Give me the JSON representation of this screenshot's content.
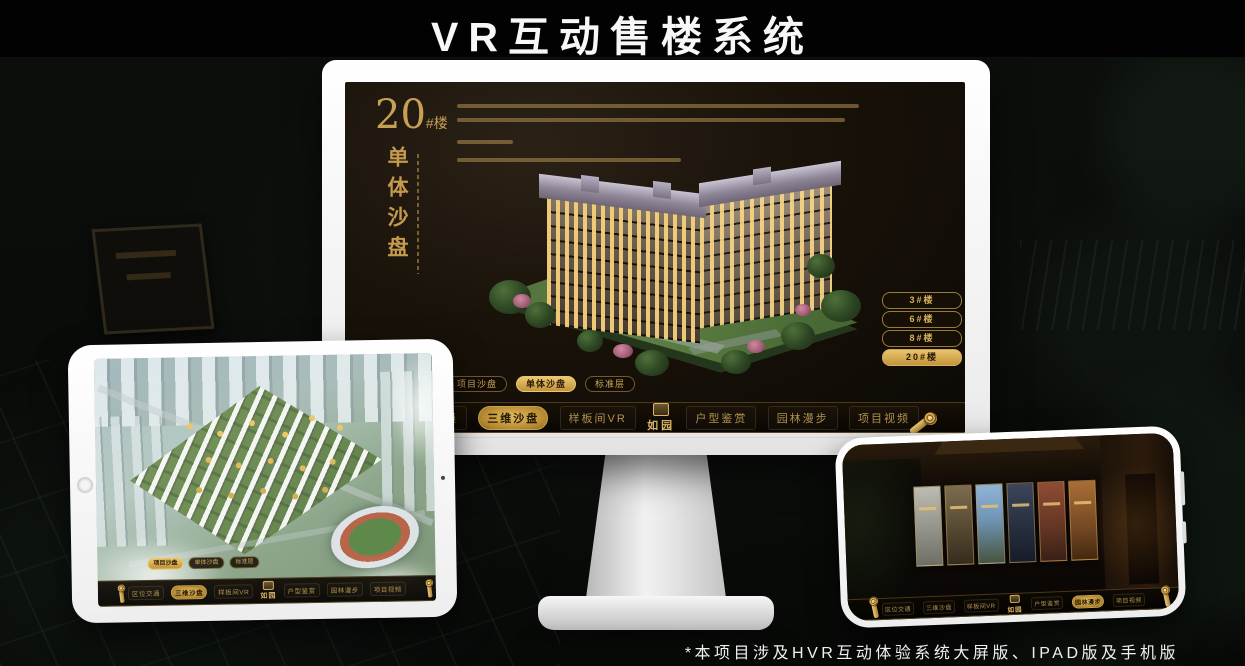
{
  "page": {
    "title": "VR互动售楼系统",
    "footnote": "*本项目涉及HVR互动体验系统大屏版、IPAD版及手机版"
  },
  "colors": {
    "gold": "#c49a4e",
    "gold_bright": "#e2bb5e",
    "screen_dark": "#120d08"
  },
  "monitor": {
    "hero": {
      "number": "20",
      "suffix": "#楼",
      "subtitle": "单体沙盘"
    },
    "floor_buttons": [
      {
        "label": "3#楼",
        "active": false
      },
      {
        "label": "6#楼",
        "active": false
      },
      {
        "label": "8#楼",
        "active": false
      },
      {
        "label": "20#楼",
        "active": true
      }
    ],
    "tabs": [
      {
        "label": "项目沙盘",
        "active": false
      },
      {
        "label": "单体沙盘",
        "active": true
      },
      {
        "label": "标准层",
        "active": false
      }
    ],
    "nav": {
      "left": [
        {
          "label": "区位交通",
          "active": false
        },
        {
          "label": "三维沙盘",
          "active": true
        },
        {
          "label": "样板间VR",
          "active": false
        }
      ],
      "logo": "如园",
      "right": [
        {
          "label": "户型鉴赏",
          "active": false
        },
        {
          "label": "园林漫步",
          "active": false
        },
        {
          "label": "项目视频",
          "active": false
        }
      ]
    }
  },
  "ipad": {
    "tabs": [
      {
        "label": "项目沙盘",
        "active": true
      },
      {
        "label": "单体沙盘",
        "active": false
      },
      {
        "label": "标准层",
        "active": false
      }
    ],
    "nav": {
      "left": [
        {
          "label": "区位交通",
          "active": false
        },
        {
          "label": "三维沙盘",
          "active": true
        },
        {
          "label": "样板间VR",
          "active": false
        }
      ],
      "logo": "如园",
      "right": [
        {
          "label": "户型鉴赏",
          "active": false
        },
        {
          "label": "园林漫步",
          "active": false
        },
        {
          "label": "项目视频",
          "active": false
        }
      ]
    }
  },
  "phone": {
    "nav": {
      "left": [
        {
          "label": "区位交通",
          "active": false
        },
        {
          "label": "三维沙盘",
          "active": false
        },
        {
          "label": "样板间VR",
          "active": false
        }
      ],
      "logo": "如园",
      "right": [
        {
          "label": "户型鉴赏",
          "active": false
        },
        {
          "label": "园林漫步",
          "active": true
        },
        {
          "label": "项目视频",
          "active": false
        }
      ]
    }
  }
}
